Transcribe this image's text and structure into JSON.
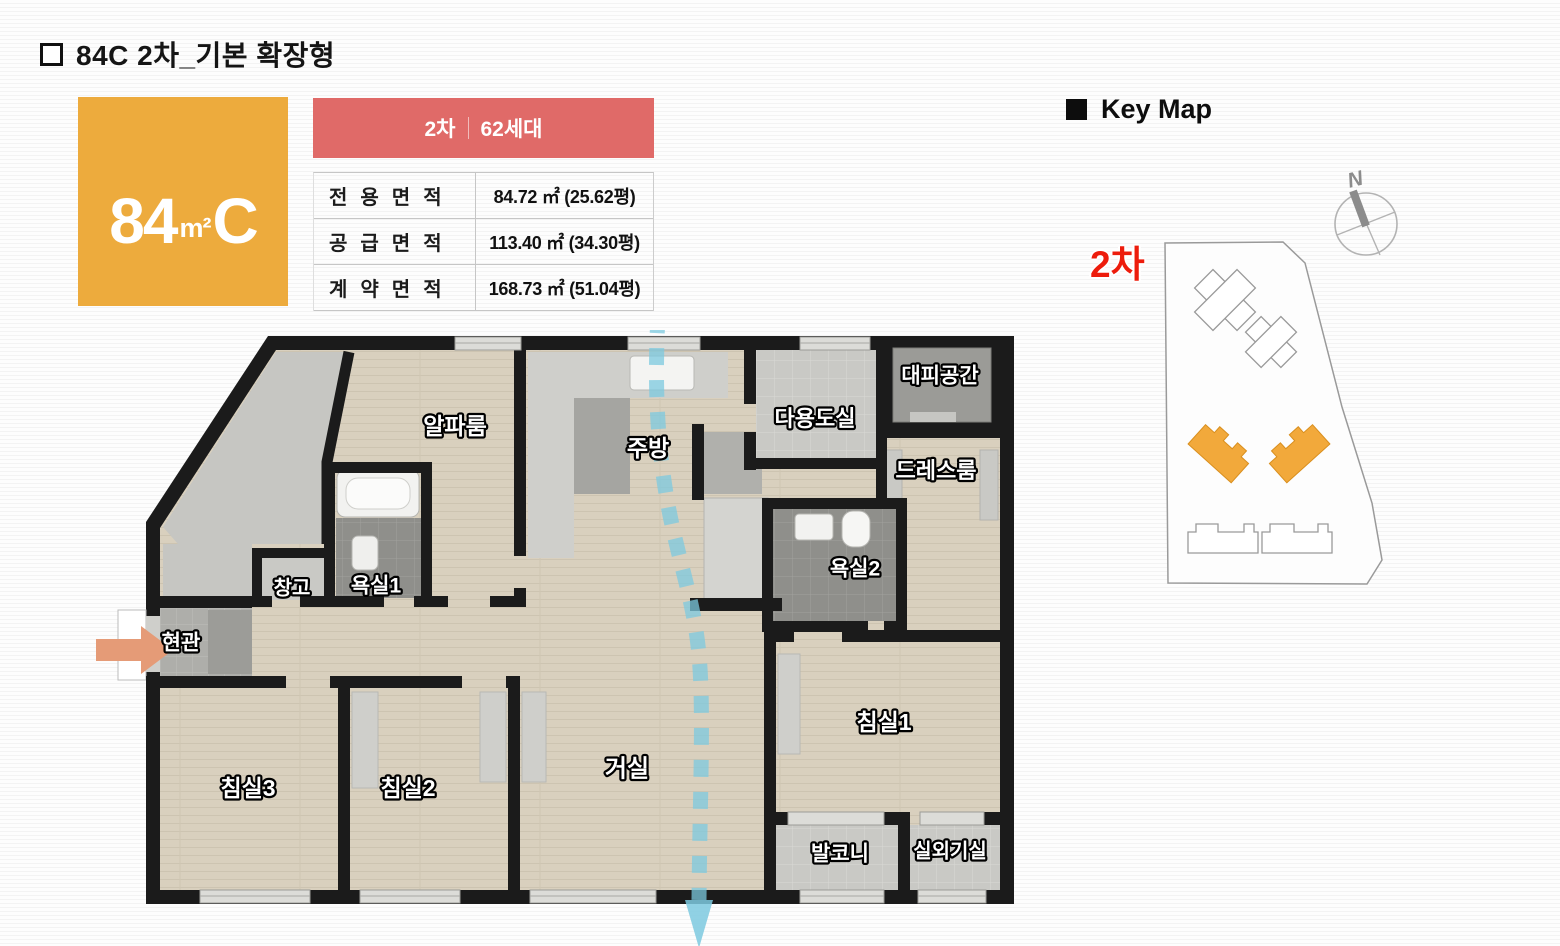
{
  "title": "84C 2차_기본 확장형",
  "area_box": {
    "size": "84",
    "unit": "m²",
    "type": "C",
    "color": "#EDAB3D"
  },
  "info_table": {
    "header": {
      "phase": "2차",
      "units": "62세대",
      "color": "#E06A68"
    },
    "rows": [
      {
        "label": "전용면적",
        "value": "84.72 ㎡ (25.62평)"
      },
      {
        "label": "공급면적",
        "value": "113.40 ㎡ (34.30평)"
      },
      {
        "label": "계약면적",
        "value": "168.73 ㎡ (51.04평)"
      }
    ]
  },
  "key_map": {
    "title": "Key Map",
    "phase_label": "2차",
    "phase_color": "#ED1C0C",
    "compass_label": "N",
    "highlight_color": "#F2A93B"
  },
  "floorplan": {
    "wall_color": "#1B1B1B",
    "floor_color": "#D9D0BE",
    "vent_color": "#7CC9DF",
    "entry_arrow_color": "#E59B77",
    "rooms": [
      {
        "name": "alpha-room",
        "label": "알파룸",
        "x": 455,
        "y": 428,
        "fs": 23
      },
      {
        "name": "kitchen",
        "label": "주방",
        "x": 648,
        "y": 450,
        "fs": 23
      },
      {
        "name": "utility-room",
        "label": "다용도실",
        "x": 815,
        "y": 420,
        "fs": 22
      },
      {
        "name": "shelter",
        "label": "대피공간",
        "x": 940,
        "y": 377,
        "fs": 21
      },
      {
        "name": "dress-room",
        "label": "드레스룸",
        "x": 936,
        "y": 472,
        "fs": 22
      },
      {
        "name": "bathroom1",
        "label": "욕실1",
        "x": 376,
        "y": 587,
        "fs": 21
      },
      {
        "name": "storage",
        "label": "창고",
        "x": 292,
        "y": 589,
        "fs": 20
      },
      {
        "name": "bathroom2",
        "label": "욕실2",
        "x": 855,
        "y": 570,
        "fs": 21
      },
      {
        "name": "entrance",
        "label": "현관",
        "x": 181,
        "y": 644,
        "fs": 21
      },
      {
        "name": "bedroom3",
        "label": "침실3",
        "x": 248,
        "y": 790,
        "fs": 23
      },
      {
        "name": "bedroom2",
        "label": "침실2",
        "x": 408,
        "y": 790,
        "fs": 23
      },
      {
        "name": "living-room",
        "label": "거실",
        "x": 627,
        "y": 770,
        "fs": 24
      },
      {
        "name": "bedroom1",
        "label": "침실1",
        "x": 884,
        "y": 724,
        "fs": 23
      },
      {
        "name": "balcony",
        "label": "발코니",
        "x": 840,
        "y": 855,
        "fs": 21
      },
      {
        "name": "ac-unit-room",
        "label": "실외기실",
        "x": 950,
        "y": 852,
        "fs": 20
      }
    ]
  }
}
